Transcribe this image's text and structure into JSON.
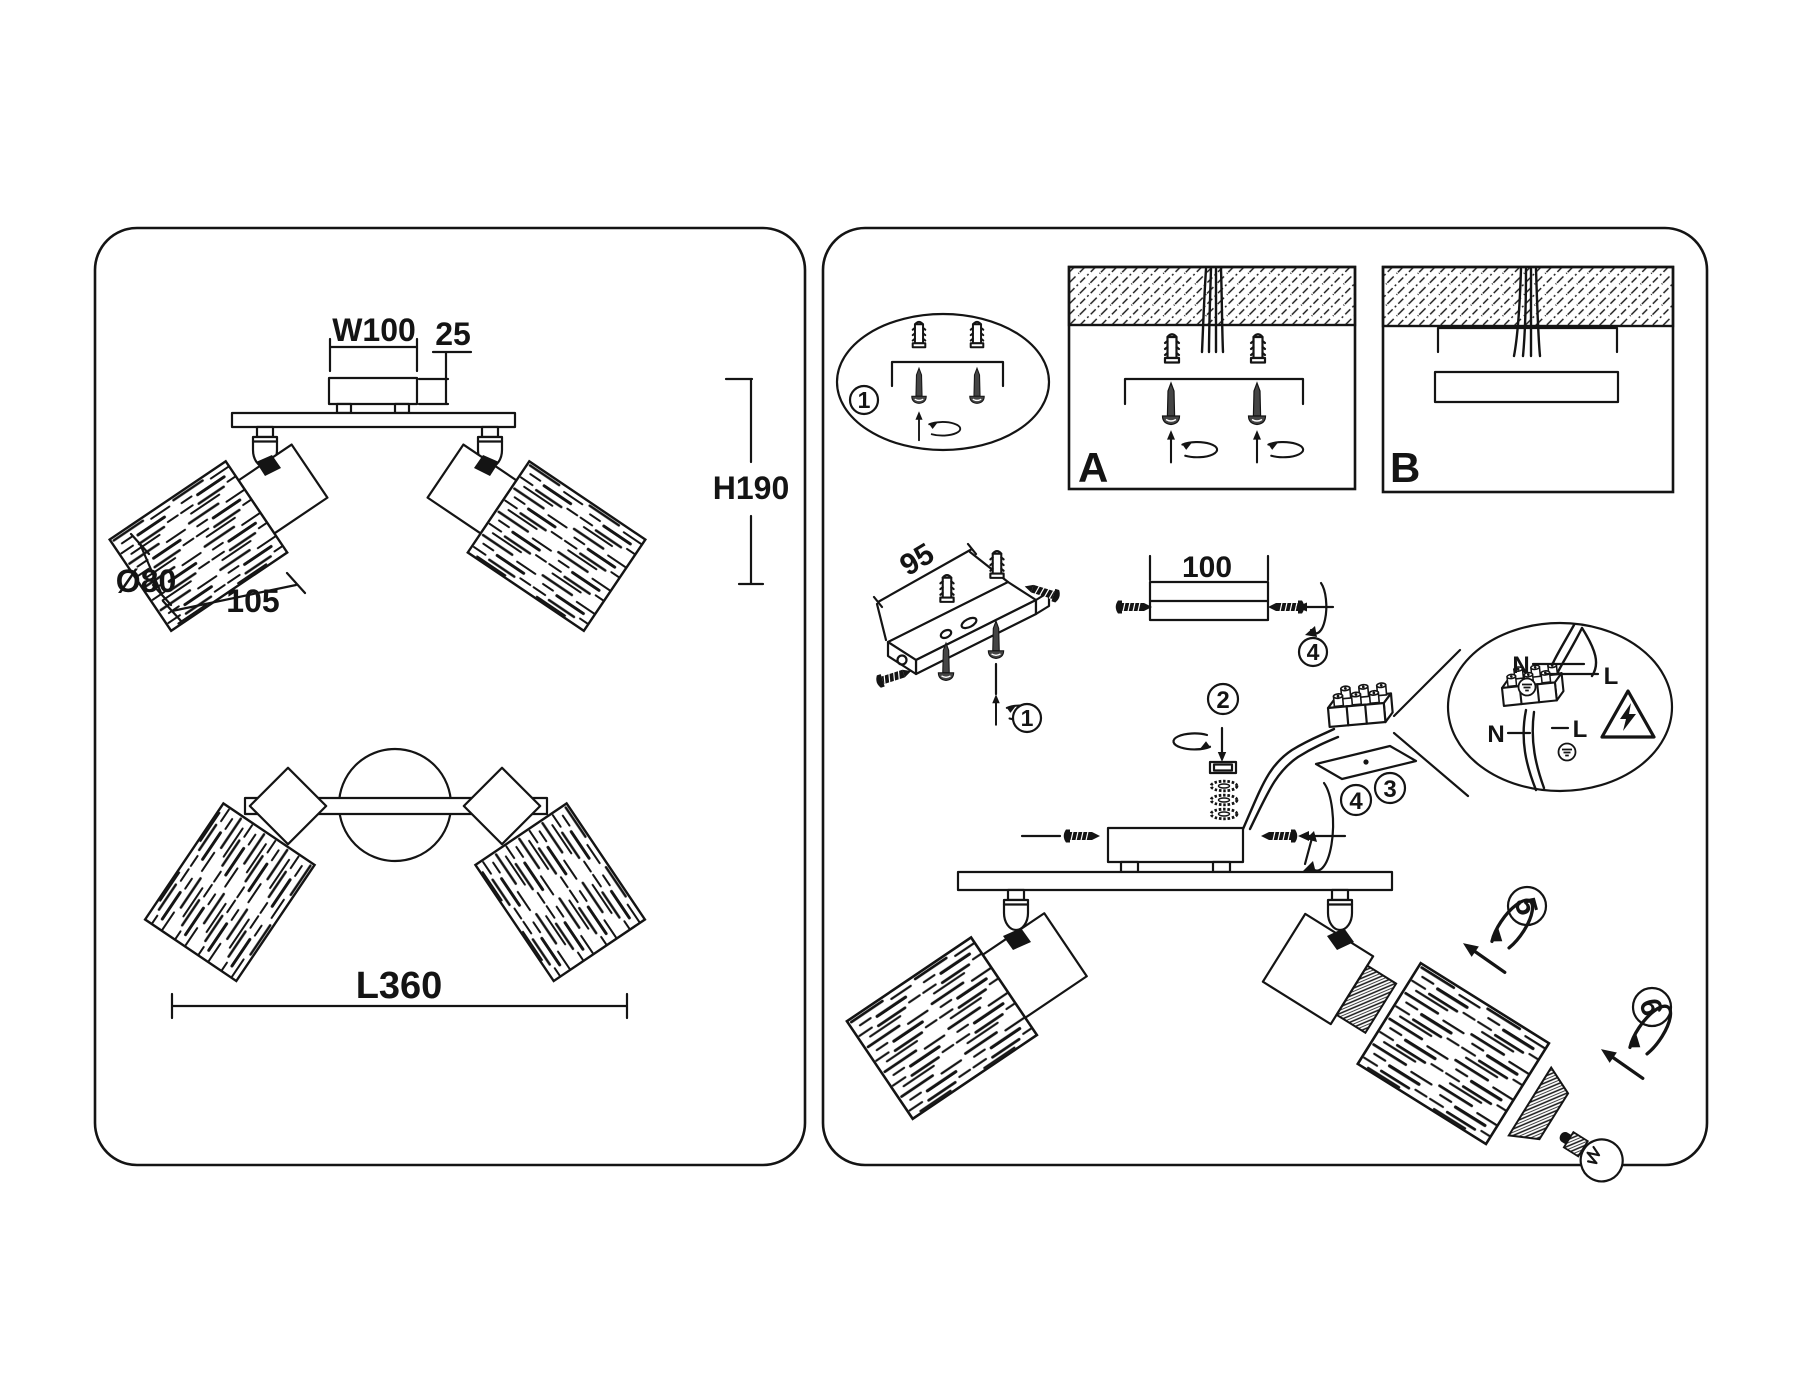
{
  "left_panel": {
    "front_view": {
      "canopy_width": "W100",
      "canopy_depth": "25",
      "height": "H190",
      "shade_diameter": "Ø80",
      "shade_length": "105"
    },
    "top_view": {
      "length": "L360"
    }
  },
  "right_panel": {
    "mount_overview": {
      "step": "1"
    },
    "method_a": {
      "label": "A"
    },
    "method_b": {
      "label": "B"
    },
    "bracket_detail": {
      "hole_spacing": "95",
      "step": "1"
    },
    "canopy_detail": {
      "width": "100",
      "step": "4"
    },
    "steps": {
      "insert_wires": "2",
      "terminal": "3",
      "attach_canopy": "4",
      "adjust_head": "5",
      "install_bulb": "6"
    },
    "wiring_detail": {
      "neutral_top": "N",
      "live_top": "L",
      "neutral_bottom": "N",
      "live_bottom": "L"
    }
  }
}
